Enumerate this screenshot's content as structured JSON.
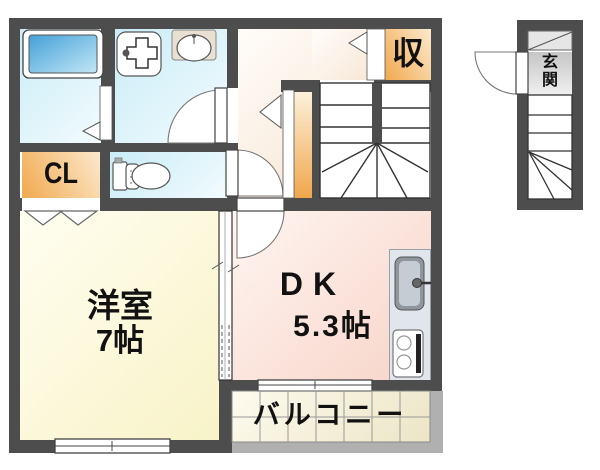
{
  "rooms": {
    "western": {
      "label": "洋室",
      "size": "7帖"
    },
    "dining_kitchen": {
      "label": "DK",
      "size": "5.3帖"
    },
    "balcony": {
      "label": "バルコニー"
    },
    "closet": {
      "label": "CL"
    },
    "storage": {
      "label": "収"
    },
    "entrance": {
      "label": "玄関",
      "char_top": "玄",
      "char_bottom": "関"
    }
  },
  "colors": {
    "wall": "#4d4d4d",
    "water_rooms": "#cdeef7",
    "storage": "#f1a94f",
    "hallway": "#f8e8d7",
    "western_room": "#f8f3c8",
    "dining_kitchen": "#f7d4c8",
    "balcony_tile": "#efe9cc",
    "railing": "#b0b0b0",
    "kitchen_counter": "#e0e6ec",
    "bathtub": "#45a0d8"
  }
}
